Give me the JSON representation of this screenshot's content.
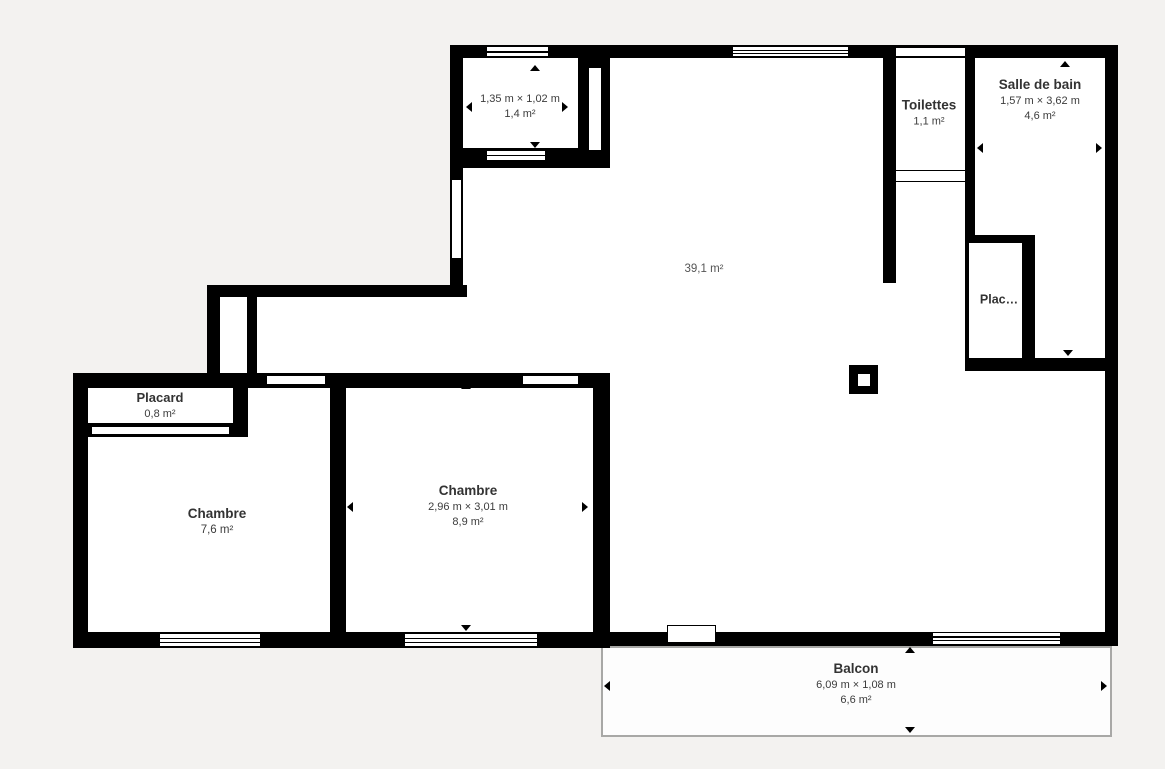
{
  "plan": {
    "title": "Floor plan",
    "colors": {
      "wall": "#000000",
      "room_fill": "#ffffff",
      "background": "#f3f2f0",
      "text": "#3c3c3c",
      "balcony_border": "#a8a8a6"
    },
    "rooms": {
      "entry_closet": {
        "dimensions": "1,35 m × 1,02 m",
        "area": "1,4 m²"
      },
      "toilettes": {
        "name": "Toilettes",
        "area": "1,1 m²"
      },
      "salle_de_bain": {
        "name": "Salle de bain",
        "dimensions": "1,57 m × 3,62 m",
        "area": "4,6 m²"
      },
      "sejour": {
        "area": "39,1 m²"
      },
      "plac": {
        "name": "Plac…"
      },
      "placard": {
        "name": "Placard",
        "area": "0,8 m²"
      },
      "chambre_1": {
        "name": "Chambre",
        "area": "7,6 m²"
      },
      "chambre_2": {
        "name": "Chambre",
        "dimensions": "2,96 m × 3,01 m",
        "area": "8,9 m²"
      },
      "balcon": {
        "name": "Balcon",
        "dimensions": "6,09 m × 1,08 m",
        "area": "6,6 m²"
      }
    }
  }
}
